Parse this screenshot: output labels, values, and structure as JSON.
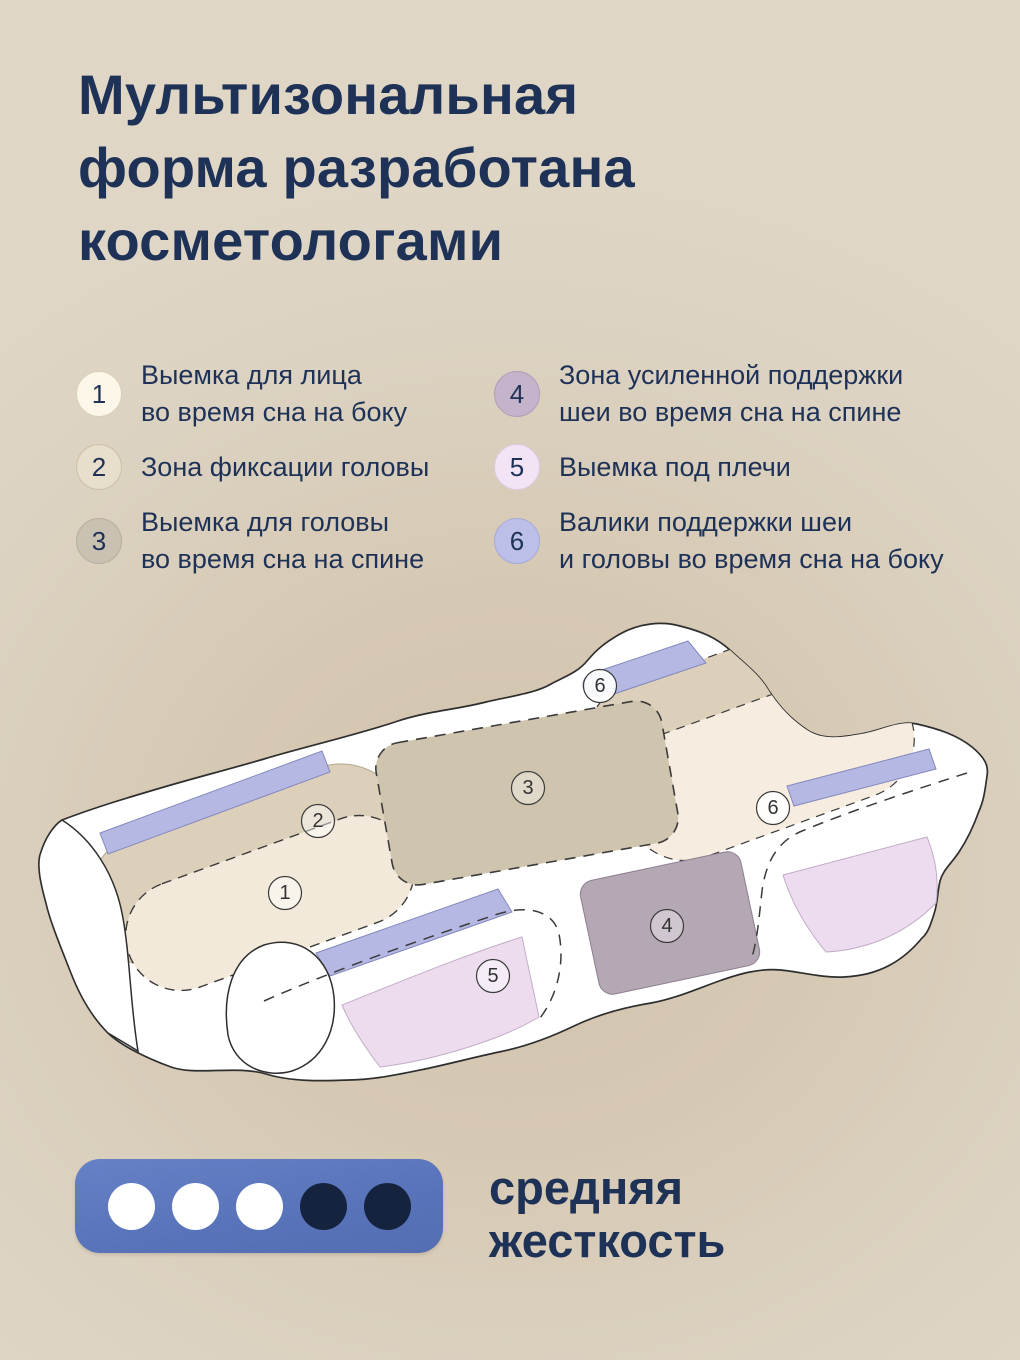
{
  "title": "Мультизональная\nформа разработана\nкосметологами",
  "legend": {
    "items": [
      {
        "number": "1",
        "text": "Выемка для лица\nво время сна на боку",
        "color": "#fdf7ea",
        "border": "#d9cfba"
      },
      {
        "number": "2",
        "text": "Зона фиксации головы",
        "color": "#e7decb",
        "border": "#ccc1aa"
      },
      {
        "number": "3",
        "text": "Выемка для головы\nво время сна на спине",
        "color": "#c9c1b1",
        "border": "#b8afa0"
      },
      {
        "number": "4",
        "text": "Зона усиленной поддержки\nшеи во время сна на спине",
        "color": "#c4b3ca",
        "border": "#b09ebb"
      },
      {
        "number": "5",
        "text": "Выемка под плечи",
        "color": "#f2e3f5",
        "border": "#ddcbe2"
      },
      {
        "number": "6",
        "text": "Валики поддержки шеи\nи головы во время сна на боку",
        "color": "#bcc0e8",
        "border": "#a6aad9"
      }
    ]
  },
  "diagram": {
    "zone_markers": [
      {
        "number": "1"
      },
      {
        "number": "2"
      },
      {
        "number": "3"
      },
      {
        "number": "4"
      },
      {
        "number": "5"
      },
      {
        "number": "6"
      },
      {
        "number": "6"
      }
    ],
    "colors": {
      "pillow": "#ffffff",
      "outline": "#2e2e2e",
      "zone1_cream": "#f3e9da",
      "zone2_beige": "#ddd0bb",
      "zone3_tan": "#cfc5ae",
      "zone4_mauve": "#b5a8b5",
      "zone5_pink": "#ecdcee",
      "roller_periwinkle": "#b4b8e2"
    }
  },
  "firmness": {
    "label": "средняя\nжесткость",
    "level": 3,
    "max": 5,
    "badge_color": "#5b76bb",
    "dot_active": "#ffffff",
    "dot_inactive": "#16233f",
    "text_color": "#1e3156"
  }
}
